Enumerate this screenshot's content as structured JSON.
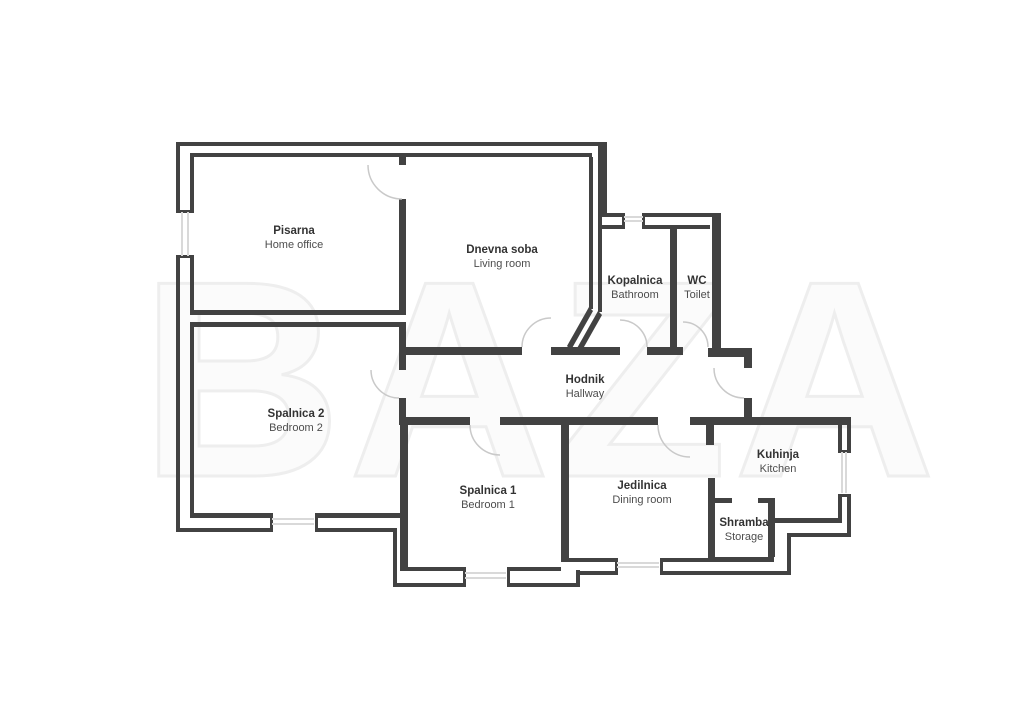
{
  "watermark": {
    "text": "BAZA"
  },
  "colors": {
    "background": "#ffffff",
    "wall": "#424242",
    "door_arc": "#c9c9c9",
    "window_glazing": "#d9d9d9",
    "label_name": "#333333",
    "label_subtitle": "#4d4d4d",
    "watermark_outline": "#eeeeee"
  },
  "rooms": {
    "pisarna": {
      "name": "Pisarna",
      "subtitle": "Home office"
    },
    "dnevna": {
      "name": "Dnevna soba",
      "subtitle": "Living room"
    },
    "kopalnica": {
      "name": "Kopalnica",
      "subtitle": "Bathroom"
    },
    "wc": {
      "name": "WC",
      "subtitle": "Toilet"
    },
    "hodnik": {
      "name": "Hodnik",
      "subtitle": "Hallway"
    },
    "spalnica2": {
      "name": "Spalnica 2",
      "subtitle": "Bedroom 2"
    },
    "spalnica1": {
      "name": "Spalnica 1",
      "subtitle": "Bedroom 1"
    },
    "jedilnica": {
      "name": "Jedilnica",
      "subtitle": "Dining room"
    },
    "kuhinja": {
      "name": "Kuhinja",
      "subtitle": "Kitchen"
    },
    "shramba": {
      "name": "Shramba",
      "subtitle": "Storage"
    }
  }
}
